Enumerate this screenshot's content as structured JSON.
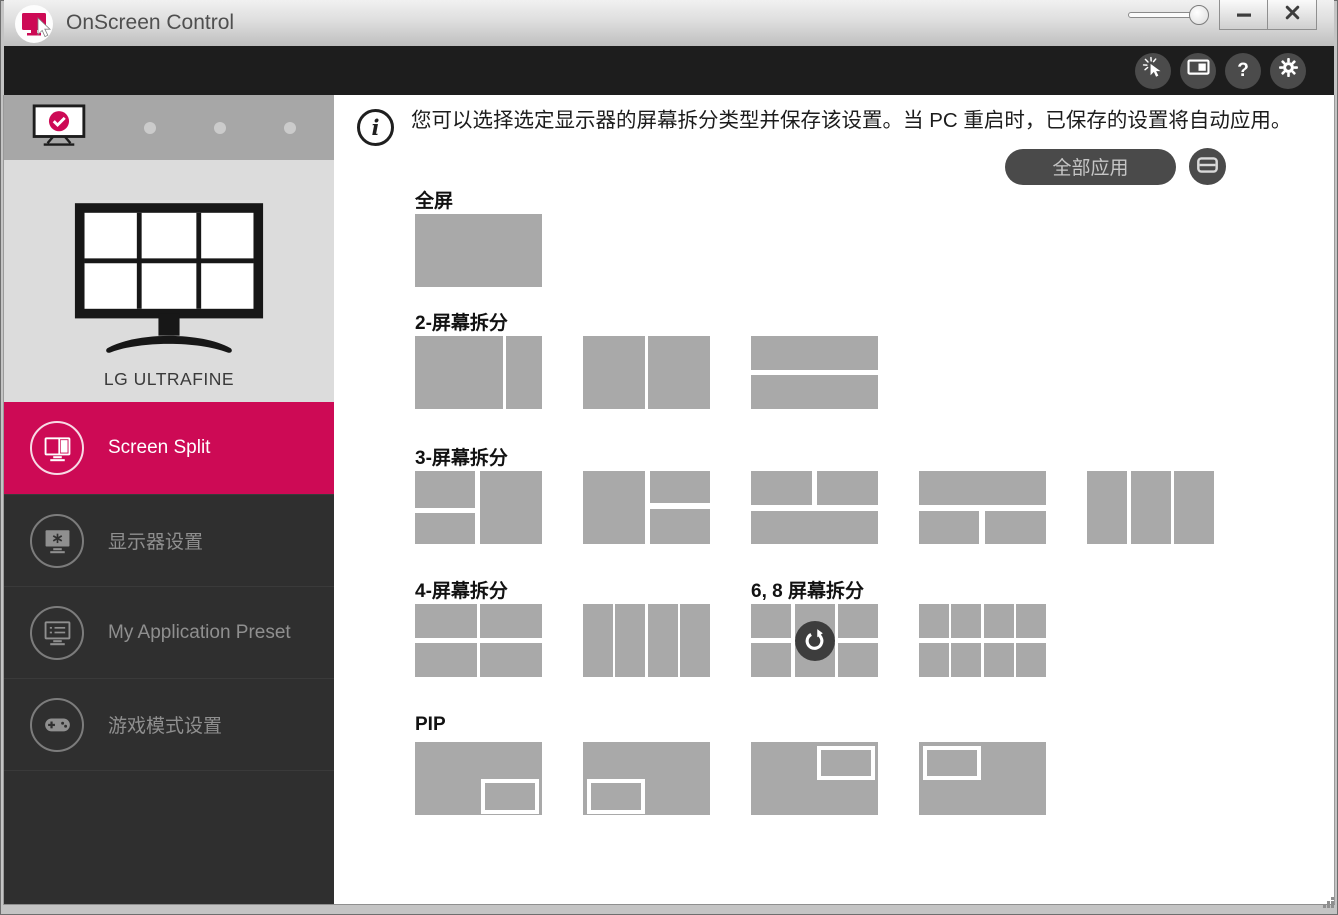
{
  "window": {
    "title": "OnScreen Control",
    "controls": [
      {
        "icon": "transparency-slider"
      },
      {
        "icon": "minimize-icon"
      },
      {
        "icon": "close-icon"
      }
    ]
  },
  "toolbar": {
    "buttons": [
      {
        "icon": "click-pointer-icon"
      },
      {
        "icon": "pip-monitor-icon"
      },
      {
        "icon": "help-icon",
        "glyph": "?"
      },
      {
        "icon": "settings-gear-icon"
      }
    ]
  },
  "sidebar": {
    "monitor_selector": {
      "selected_index": 0,
      "monitor_count": 4,
      "selected_icon": "monitor-check-icon"
    },
    "monitor_name": "LG ULTRAFINE",
    "preview_icon": "six-split-monitor-illustration",
    "items": [
      {
        "label": "Screen Split",
        "icon": "screen-split-icon",
        "active": true
      },
      {
        "label": "显示器设置",
        "icon": "monitor-settings-icon",
        "active": false
      },
      {
        "label": "My Application Preset",
        "icon": "app-preset-icon",
        "active": false
      },
      {
        "label": "游戏模式设置",
        "icon": "game-mode-icon",
        "active": false
      }
    ]
  },
  "main": {
    "info_icon": "info-icon",
    "info_text": "您可以选择选定显示器的屏幕拆分类型并保存该设置。当 PC 重启时，已保存的设置将自动应用。",
    "apply_all_label": "全部应用",
    "display_button_icon": "display-icon",
    "rows": [
      {
        "sections": [
          {
            "label": "全屏",
            "tiles": [
              {
                "cells": [
                  [
                    0,
                    0,
                    100,
                    100
                  ]
                ]
              }
            ]
          }
        ]
      },
      {
        "sections": [
          {
            "label": "2-屏幕拆分",
            "tiles": [
              {
                "cells": [
                  [
                    0,
                    0,
                    69,
                    100
                  ],
                  [
                    72,
                    0,
                    28,
                    100
                  ]
                ]
              },
              {
                "cells": [
                  [
                    0,
                    0,
                    48.5,
                    100
                  ],
                  [
                    51.5,
                    0,
                    48.5,
                    100
                  ]
                ]
              },
              {
                "cells": [
                  [
                    0,
                    0,
                    100,
                    46
                  ],
                  [
                    0,
                    54,
                    100,
                    46
                  ]
                ]
              }
            ]
          }
        ]
      },
      {
        "sections": [
          {
            "label": "3-屏幕拆分",
            "tiles": [
              {
                "cells": [
                  [
                    0,
                    0,
                    47,
                    50
                  ],
                  [
                    0,
                    57,
                    47,
                    43
                  ],
                  [
                    51,
                    0,
                    49,
                    100
                  ]
                ]
              },
              {
                "cells": [
                  [
                    0,
                    0,
                    49,
                    100
                  ],
                  [
                    53,
                    0,
                    47,
                    44
                  ],
                  [
                    53,
                    52,
                    47,
                    48
                  ]
                ]
              },
              {
                "cells": [
                  [
                    0,
                    0,
                    48,
                    47
                  ],
                  [
                    52,
                    0,
                    48,
                    47
                  ],
                  [
                    0,
                    55,
                    100,
                    45
                  ]
                ]
              },
              {
                "cells": [
                  [
                    0,
                    0,
                    100,
                    47
                  ],
                  [
                    0,
                    55,
                    47,
                    45
                  ],
                  [
                    52,
                    55,
                    48,
                    45
                  ]
                ]
              },
              {
                "cells": [
                  [
                    0,
                    0,
                    31.5,
                    100
                  ],
                  [
                    34.3,
                    0,
                    31.5,
                    100
                  ],
                  [
                    68.6,
                    0,
                    31.4,
                    100
                  ]
                ]
              }
            ]
          }
        ]
      },
      {
        "sections": [
          {
            "label": "4-屏幕拆分",
            "tiles": [
              {
                "cells": [
                  [
                    0,
                    0,
                    48.5,
                    46
                  ],
                  [
                    51.5,
                    0,
                    48.5,
                    46
                  ],
                  [
                    0,
                    54,
                    48.5,
                    46
                  ],
                  [
                    51.5,
                    54,
                    48.5,
                    46
                  ]
                ]
              },
              {
                "cells": [
                  [
                    0,
                    0,
                    23.8,
                    100
                  ],
                  [
                    25.4,
                    0,
                    23.8,
                    100
                  ],
                  [
                    50.8,
                    0,
                    23.8,
                    100
                  ],
                  [
                    76.2,
                    0,
                    23.8,
                    100
                  ]
                ]
              }
            ]
          },
          {
            "label": "6, 8 屏幕拆分",
            "tiles": [
              {
                "cells": [
                  [
                    0,
                    0,
                    31.5,
                    46
                  ],
                  [
                    34.3,
                    0,
                    31.5,
                    46
                  ],
                  [
                    68.6,
                    0,
                    31.4,
                    46
                  ],
                  [
                    0,
                    54,
                    31.5,
                    46
                  ],
                  [
                    34.3,
                    54,
                    31.5,
                    46
                  ],
                  [
                    68.6,
                    54,
                    31.4,
                    46
                  ]
                ],
                "overlay": "rotate-icon"
              },
              {
                "cells": [
                  [
                    0,
                    0,
                    23.8,
                    46
                  ],
                  [
                    25.4,
                    0,
                    23.8,
                    46
                  ],
                  [
                    50.8,
                    0,
                    23.8,
                    46
                  ],
                  [
                    76.2,
                    0,
                    23.8,
                    46
                  ],
                  [
                    0,
                    54,
                    23.8,
                    46
                  ],
                  [
                    25.4,
                    54,
                    23.8,
                    46
                  ],
                  [
                    50.8,
                    54,
                    23.8,
                    46
                  ],
                  [
                    76.2,
                    54,
                    23.8,
                    46
                  ]
                ]
              }
            ]
          }
        ]
      },
      {
        "sections": [
          {
            "label": "PIP",
            "tiles": [
              {
                "cells": [
                  [
                    0,
                    0,
                    100,
                    100
                  ]
                ],
                "pip": [
                  52,
                  51,
                  46,
                  47
                ]
              },
              {
                "cells": [
                  [
                    0,
                    0,
                    100,
                    100
                  ]
                ],
                "pip": [
                  3,
                  51,
                  46,
                  47
                ]
              },
              {
                "cells": [
                  [
                    0,
                    0,
                    100,
                    100
                  ]
                ],
                "pip": [
                  52,
                  5,
                  46,
                  47
                ]
              },
              {
                "cells": [
                  [
                    0,
                    0,
                    100,
                    100
                  ]
                ],
                "pip": [
                  3,
                  5,
                  46,
                  47
                ]
              }
            ]
          }
        ]
      }
    ]
  },
  "colors": {
    "accent_pink": "#cd0a55",
    "tile_gray": "#a9a9a9",
    "toolbar_black": "#1d1d1d",
    "sidebar_dark": "#2f2f2f"
  }
}
